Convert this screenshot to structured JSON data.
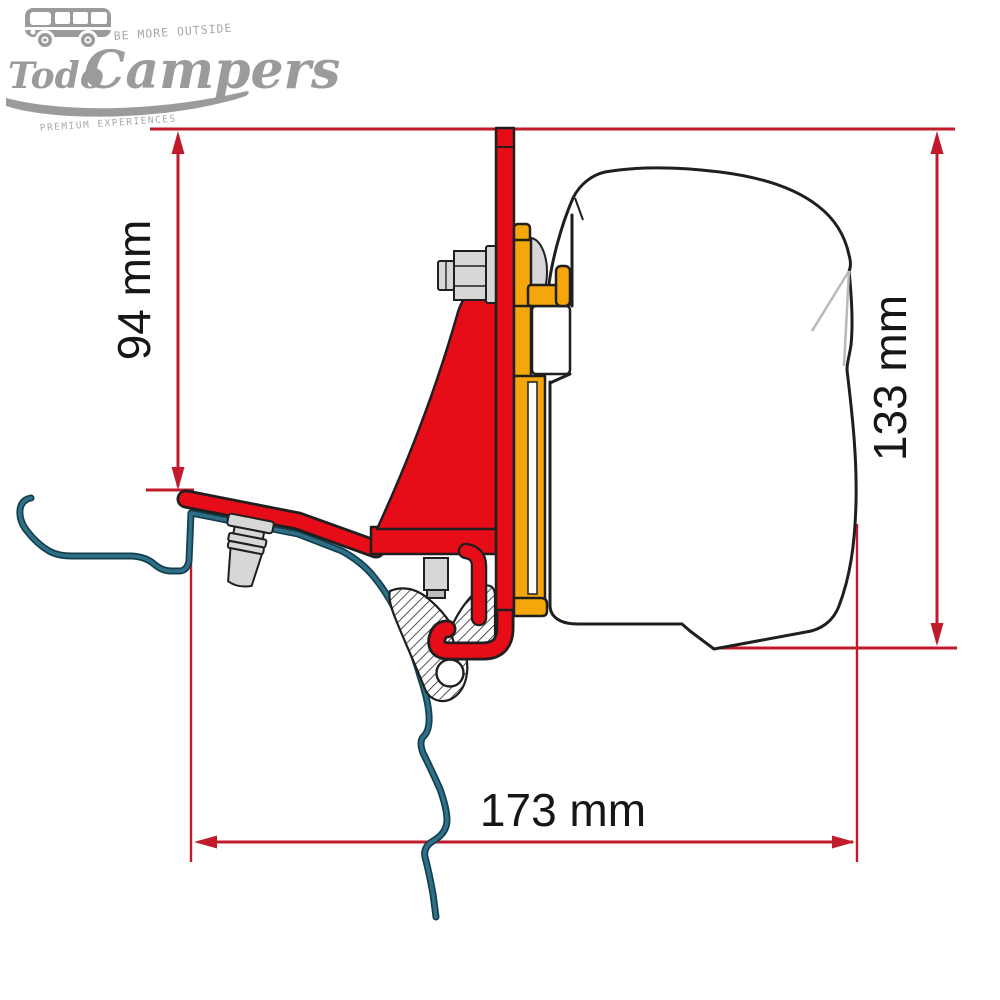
{
  "logo": {
    "brand": "Todo Campers",
    "word1": "Todo",
    "word2": "Campers",
    "tagline_top": "BE MORE OUTSIDE",
    "tagline_bottom": "PREMIUM EXPERIENCES"
  },
  "dimensions": {
    "left_vertical": "94 mm",
    "right_vertical": "133 mm",
    "bottom_horizontal": "173 mm"
  },
  "colors": {
    "dimension_red": "#c11a2b",
    "bracket_red": "#e60c18",
    "rail_yellow": "#f5a60a",
    "roof_line_teal": "#2f7088",
    "outline_black": "#1f1f1f",
    "logo_gray": "#9b9b9b"
  }
}
